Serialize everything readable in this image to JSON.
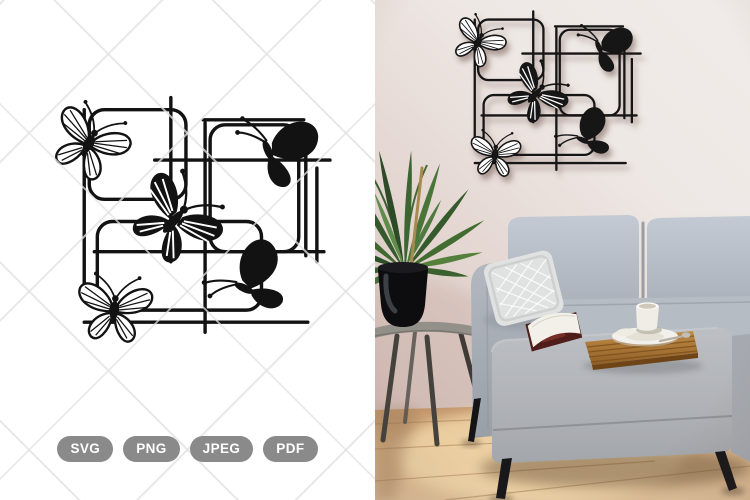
{
  "image": {
    "width": 750,
    "height": 500,
    "background": "#ffffff"
  },
  "left_panel": {
    "subject": "butterfly-trellis-cut-file-preview",
    "design": {
      "color": "#121212",
      "butterfly_count": 5,
      "grid_squares": 3,
      "butterflies": [
        "outline-top-left",
        "solid-top-right",
        "dark-center",
        "outline-bottom-left",
        "solid-bottom-right"
      ]
    },
    "watermark": {
      "pattern": "diagonal-cross-lines",
      "color": "#ececec"
    },
    "format_badges": {
      "bg_color": "#8a8a8a",
      "text_color": "#ffffff",
      "labels": [
        "SVG",
        "PNG",
        "JPEG",
        "PDF"
      ]
    }
  },
  "right_panel": {
    "subject": "living-room-wall-mockup-photo",
    "wall_art": {
      "subject": "butterfly-trellis-wall-decor",
      "color": "#161616",
      "butterfly_count": 5
    },
    "colors": {
      "wall": "#e7dad5",
      "floor": "#d8b286",
      "sofa": "#b5bbc3",
      "pillow": "#e0e2e1",
      "plant_leaves": "#3d6532",
      "plant_pot": "#0d0d0f",
      "side_table": "#93908a",
      "wood_tray": "#b07c3c",
      "magazine_cover": "#4f1d1a",
      "coffee_cup": "#f0ede6",
      "sofa_legs": "#18181a"
    }
  }
}
